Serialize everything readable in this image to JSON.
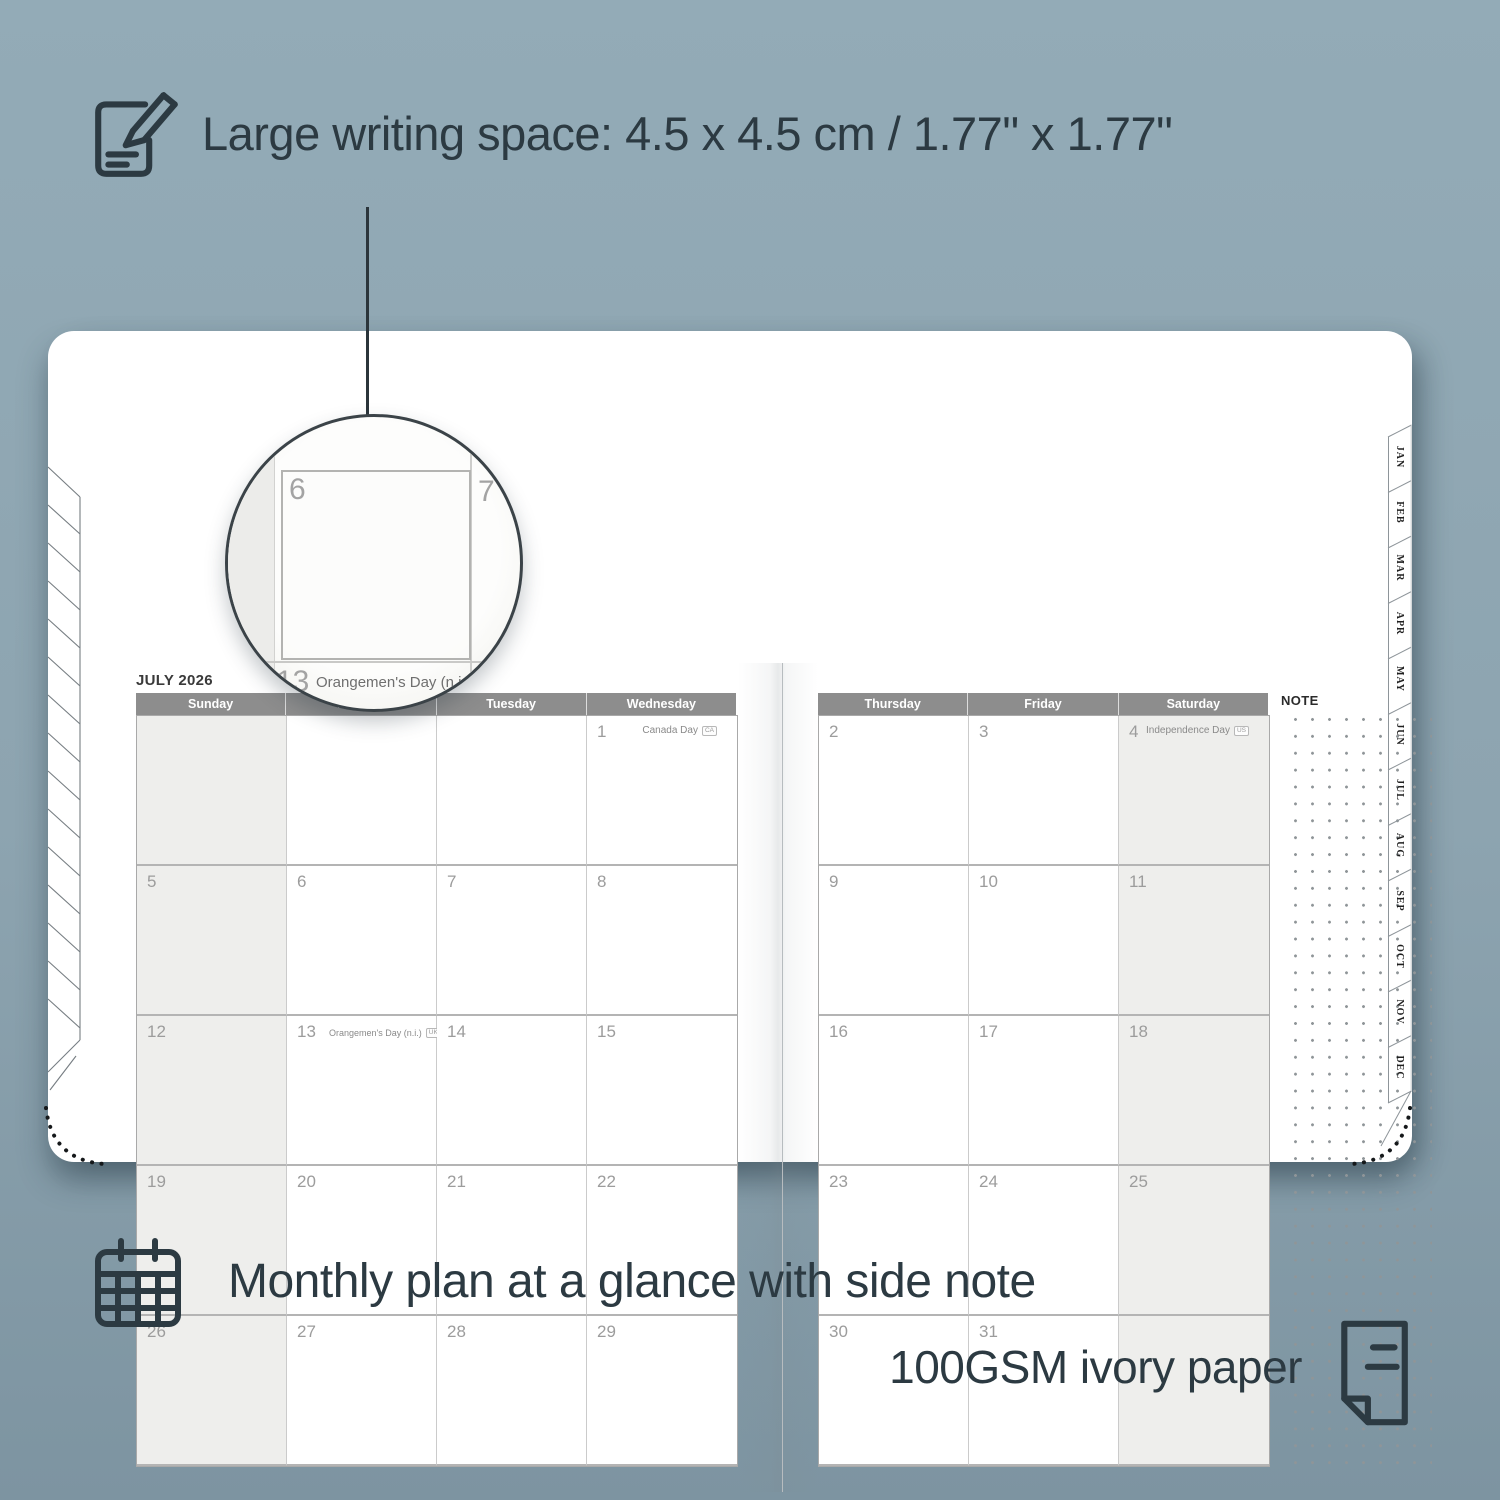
{
  "features": {
    "writing_space": "Large writing space: 4.5 x 4.5 cm / 1.77\" x 1.77\"",
    "monthly": "Monthly plan at a glance with side note",
    "paper": "100GSM ivory paper"
  },
  "planner": {
    "title": "JULY 2026",
    "note_label": "NOTE",
    "left_day_headers": [
      "Sunday",
      "Monday",
      "Tuesday",
      "Wednesday"
    ],
    "right_day_headers": [
      "Thursday",
      "Friday",
      "Saturday"
    ],
    "month_tabs": [
      "JAN",
      "FEB",
      "MAR",
      "APR",
      "MAY",
      "JUN",
      "JUL",
      "AUG",
      "SEP",
      "OCT",
      "NOV",
      "DEC"
    ],
    "left_rows": [
      [
        {
          "d": "",
          "shade": true
        },
        {
          "d": ""
        },
        {
          "d": ""
        },
        {
          "d": "1",
          "holiday": "Canada Day",
          "badge": "CA"
        }
      ],
      [
        {
          "d": "5",
          "shade": true
        },
        {
          "d": "6"
        },
        {
          "d": "7"
        },
        {
          "d": "8"
        }
      ],
      [
        {
          "d": "12",
          "shade": true
        },
        {
          "d": "13",
          "holiday": "Orangemen's Day (n.i.)",
          "badge": "UK",
          "inline": true
        },
        {
          "d": "14"
        },
        {
          "d": "15"
        }
      ],
      [
        {
          "d": "19",
          "shade": true
        },
        {
          "d": "20"
        },
        {
          "d": "21"
        },
        {
          "d": "22"
        }
      ],
      [
        {
          "d": "26",
          "shade": true
        },
        {
          "d": "27"
        },
        {
          "d": "28"
        },
        {
          "d": "29"
        }
      ]
    ],
    "right_rows": [
      [
        {
          "d": "2"
        },
        {
          "d": "3"
        },
        {
          "d": "4",
          "holiday": "Independence Day",
          "badge": "US",
          "shade": true
        }
      ],
      [
        {
          "d": "9"
        },
        {
          "d": "10"
        },
        {
          "d": "11",
          "shade": true
        }
      ],
      [
        {
          "d": "16"
        },
        {
          "d": "17"
        },
        {
          "d": "18",
          "shade": true
        }
      ],
      [
        {
          "d": "23"
        },
        {
          "d": "24"
        },
        {
          "d": "25",
          "shade": true
        }
      ],
      [
        {
          "d": "30"
        },
        {
          "d": "31"
        },
        {
          "d": "",
          "shade": true
        }
      ]
    ]
  },
  "magnifier": {
    "zoom_day": "6",
    "adjacent_day": "7",
    "below_day": "13",
    "below_holiday": "Orangemen's Day (n.i.)",
    "below_badge": "UK"
  },
  "colors": {
    "background": "#8da4b0",
    "ink": "#2c3a42",
    "page": "#ffffff",
    "header_bar": "#8d8d8d",
    "weekend_fill": "#eeeeec",
    "grid_line": "#c6c6c6",
    "date_number": "#9c9c9c",
    "holiday_text": "#8a8a8a"
  }
}
